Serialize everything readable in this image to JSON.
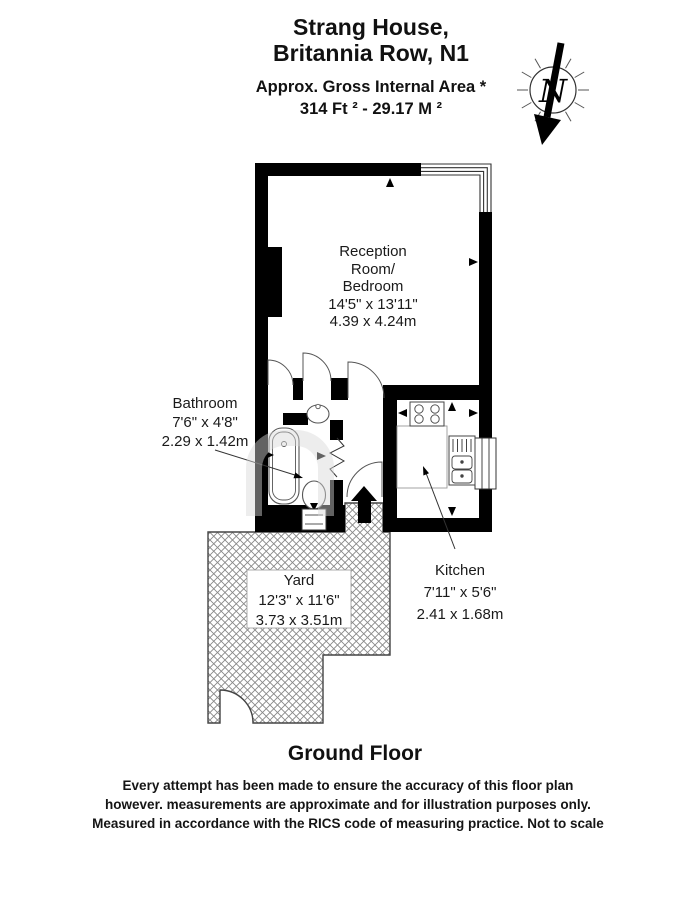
{
  "header": {
    "title_line1": "Strang House,",
    "title_line2": "Britannia Row, N1",
    "area_label": "Approx. Gross Internal Area *",
    "area_value": "314 Ft ²  -  29.17 M ²"
  },
  "compass": {
    "north_label": "N"
  },
  "rooms": {
    "reception": {
      "name_line1": "Reception",
      "name_line2": "Room/",
      "name_line3": "Bedroom",
      "dims_imperial": "14'5\" x 13'11\"",
      "dims_metric": "4.39 x 4.24m"
    },
    "bathroom": {
      "name": "Bathroom",
      "dims_imperial": "7'6\" x 4'8\"",
      "dims_metric": "2.29 x 1.42m"
    },
    "kitchen": {
      "name": "Kitchen",
      "dims_imperial": "7'11\" x 5'6\"",
      "dims_metric": "2.41 x 1.68m"
    },
    "yard": {
      "name": "Yard",
      "dims_imperial": "12'3\" x 11'6\"",
      "dims_metric": "3.73 x 3.51m"
    }
  },
  "floor_label": "Ground Floor",
  "disclaimer": {
    "line1": "Every attempt has been made to ensure the accuracy of this floor plan",
    "line2": "however. measurements are approximate and for illustration purposes only.",
    "line3": "Measured in accordance with the RICS code of measuring practice. Not to scale"
  },
  "colors": {
    "wall": "#000000",
    "line": "#4a4a4a",
    "hatch": "#888888",
    "background": "#ffffff"
  }
}
